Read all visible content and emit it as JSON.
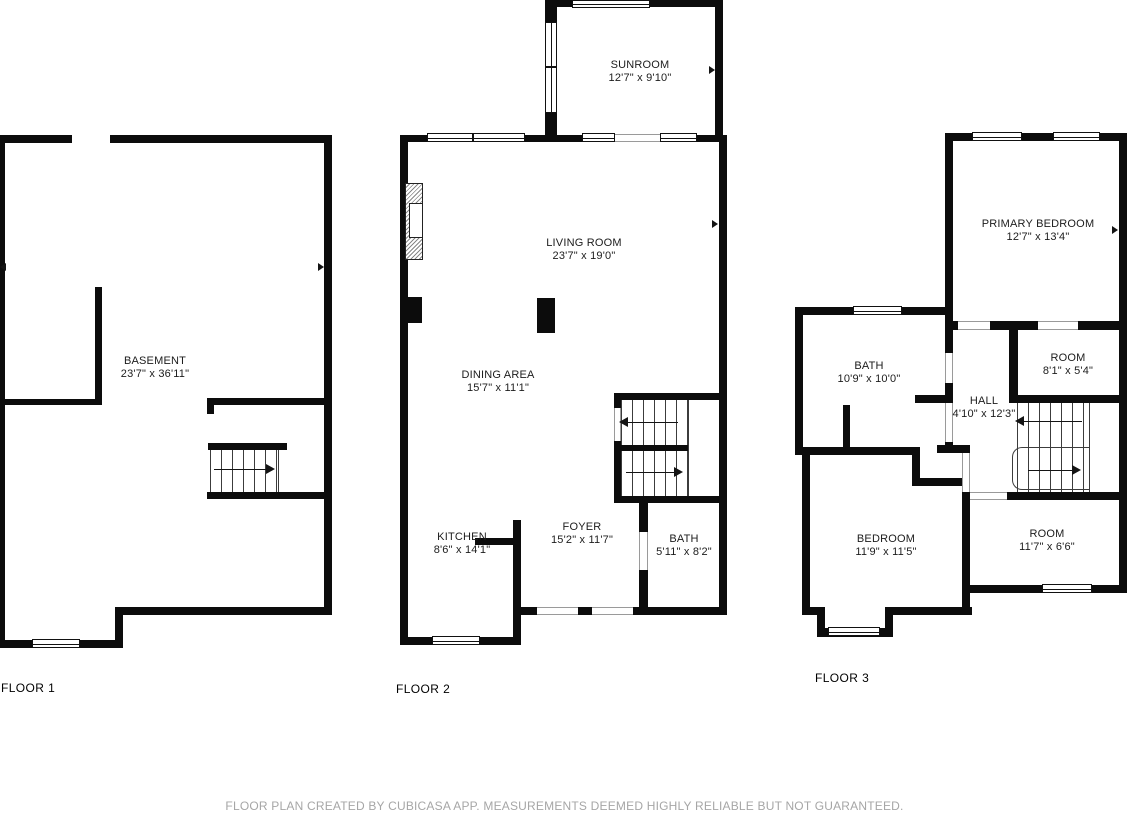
{
  "floors": [
    {
      "label": "FLOOR 1",
      "rooms": [
        {
          "name": "BASEMENT",
          "dims": "23'7\" x 36'11\""
        }
      ]
    },
    {
      "label": "FLOOR 2",
      "rooms": [
        {
          "name": "SUNROOM",
          "dims": "12'7\" x 9'10\""
        },
        {
          "name": "LIVING ROOM",
          "dims": "23'7\" x 19'0\""
        },
        {
          "name": "DINING AREA",
          "dims": "15'7\" x 11'1\""
        },
        {
          "name": "KITCHEN",
          "dims": "8'6\" x 14'1\""
        },
        {
          "name": "FOYER",
          "dims": "15'2\" x 11'7\""
        },
        {
          "name": "BATH",
          "dims": "5'11\" x 8'2\""
        }
      ]
    },
    {
      "label": "FLOOR 3",
      "rooms": [
        {
          "name": "PRIMARY BEDROOM",
          "dims": "12'7\" x 13'4\""
        },
        {
          "name": "BATH",
          "dims": "10'9\" x 10'0\""
        },
        {
          "name": "ROOM",
          "dims": "8'1\" x 5'4\""
        },
        {
          "name": "HALL",
          "dims": "4'10\" x 12'3\""
        },
        {
          "name": "BEDROOM",
          "dims": "11'9\" x 11'5\""
        },
        {
          "name": "ROOM",
          "dims": "11'7\" x 6'6\""
        }
      ]
    }
  ],
  "disclaimer": "FLOOR PLAN CREATED BY CUBICASA APP. MEASUREMENTS DEEMED HIGHLY RELIABLE BUT NOT GUARANTEED.",
  "colors": {
    "wall": "#0c0c0c",
    "background": "#ffffff",
    "label_text": "#1c1c1c",
    "disclaimer_text": "#a6a6a6"
  }
}
